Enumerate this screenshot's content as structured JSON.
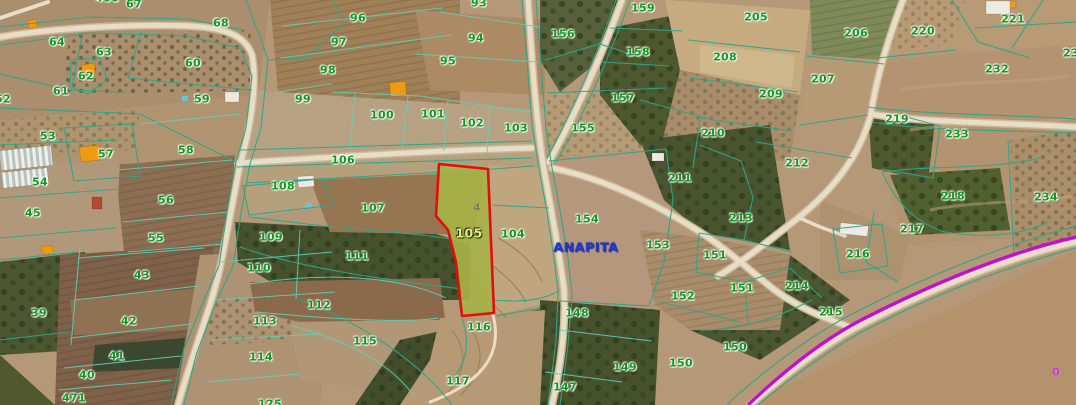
{
  "map": {
    "place_label": {
      "text": "ANAPITA",
      "x": 586,
      "y": 247
    },
    "road_marker": {
      "text": "0",
      "x": 1056,
      "y": 372
    },
    "highlighted_parcel": {
      "number": "105",
      "sub_label": "4",
      "label_x": 469,
      "label_y": 233,
      "sub_x": 477,
      "sub_y": 208,
      "polygon": "439,164 488,169 494,313 462,316 456,262 448,230 436,216"
    },
    "colors": {
      "boundary": "#2ca68b",
      "boundary-light": "#5fd0ba",
      "parcel-label": "#0c9b1c",
      "highlight-fill": "#a6b246",
      "highlight-outline": "#e30d0d",
      "highlight-label": "#dff07c",
      "place-label": "#1d39d4",
      "purple-road": "#bf10cf",
      "road-fill": "#e8ddc6",
      "road-casing": "#cbb999"
    },
    "parcel_labels": [
      {
        "t": "466",
        "x": 107,
        "y": -2
      },
      {
        "t": "67",
        "x": 134,
        "y": 4
      },
      {
        "t": "96",
        "x": 358,
        "y": 18
      },
      {
        "t": "93",
        "x": 479,
        "y": 3
      },
      {
        "t": "159",
        "x": 643,
        "y": 8
      },
      {
        "t": "205",
        "x": 756,
        "y": 17
      },
      {
        "t": "221",
        "x": 1013,
        "y": 19
      },
      {
        "t": "220",
        "x": 923,
        "y": 31
      },
      {
        "t": "68",
        "x": 221,
        "y": 23
      },
      {
        "t": "64",
        "x": 57,
        "y": 42
      },
      {
        "t": "97",
        "x": 339,
        "y": 42
      },
      {
        "t": "94",
        "x": 476,
        "y": 38
      },
      {
        "t": "156",
        "x": 563,
        "y": 34
      },
      {
        "t": "206",
        "x": 856,
        "y": 33
      },
      {
        "t": "63",
        "x": 104,
        "y": 52
      },
      {
        "t": "95",
        "x": 448,
        "y": 61
      },
      {
        "t": "158",
        "x": 638,
        "y": 52
      },
      {
        "t": "232",
        "x": 997,
        "y": 69
      },
      {
        "t": "23",
        "x": 1071,
        "y": 53
      },
      {
        "t": "62",
        "x": 86,
        "y": 76
      },
      {
        "t": "98",
        "x": 328,
        "y": 70
      },
      {
        "t": "60",
        "x": 193,
        "y": 63
      },
      {
        "t": "207",
        "x": 823,
        "y": 79
      },
      {
        "t": "208",
        "x": 725,
        "y": 57
      },
      {
        "t": "209",
        "x": 771,
        "y": 94
      },
      {
        "t": "61",
        "x": 61,
        "y": 91
      },
      {
        "t": "99",
        "x": 303,
        "y": 99
      },
      {
        "t": "59",
        "x": 202,
        "y": 99
      },
      {
        "t": "52",
        "x": 3,
        "y": 99
      },
      {
        "t": "100",
        "x": 382,
        "y": 115
      },
      {
        "t": "101",
        "x": 433,
        "y": 114
      },
      {
        "t": "102",
        "x": 472,
        "y": 123
      },
      {
        "t": "103",
        "x": 516,
        "y": 128
      },
      {
        "t": "157",
        "x": 623,
        "y": 98
      },
      {
        "t": "219",
        "x": 897,
        "y": 119
      },
      {
        "t": "210",
        "x": 713,
        "y": 133
      },
      {
        "t": "155",
        "x": 583,
        "y": 128
      },
      {
        "t": "233",
        "x": 957,
        "y": 134
      },
      {
        "t": "53",
        "x": 48,
        "y": 136
      },
      {
        "t": "58",
        "x": 186,
        "y": 150
      },
      {
        "t": "57",
        "x": 106,
        "y": 154
      },
      {
        "t": "106",
        "x": 343,
        "y": 160
      },
      {
        "t": "212",
        "x": 797,
        "y": 163
      },
      {
        "t": "211",
        "x": 680,
        "y": 178
      },
      {
        "t": "54",
        "x": 40,
        "y": 182
      },
      {
        "t": "108",
        "x": 283,
        "y": 186
      },
      {
        "t": "56",
        "x": 166,
        "y": 200
      },
      {
        "t": "218",
        "x": 953,
        "y": 196
      },
      {
        "t": "234",
        "x": 1046,
        "y": 197
      },
      {
        "t": "107",
        "x": 373,
        "y": 208
      },
      {
        "t": "45",
        "x": 33,
        "y": 213
      },
      {
        "t": "154",
        "x": 587,
        "y": 219
      },
      {
        "t": "213",
        "x": 741,
        "y": 218
      },
      {
        "t": "217",
        "x": 912,
        "y": 229
      },
      {
        "t": "104",
        "x": 513,
        "y": 234
      },
      {
        "t": "109",
        "x": 271,
        "y": 237
      },
      {
        "t": "55",
        "x": 156,
        "y": 238
      },
      {
        "t": "153",
        "x": 658,
        "y": 245
      },
      {
        "t": "151",
        "x": 715,
        "y": 255
      },
      {
        "t": "216",
        "x": 858,
        "y": 254
      },
      {
        "t": "111",
        "x": 357,
        "y": 256
      },
      {
        "t": "110",
        "x": 259,
        "y": 268
      },
      {
        "t": "43",
        "x": 142,
        "y": 275
      },
      {
        "t": "151",
        "x": 742,
        "y": 288
      },
      {
        "t": "214",
        "x": 797,
        "y": 286
      },
      {
        "t": "152",
        "x": 683,
        "y": 296
      },
      {
        "t": "112",
        "x": 319,
        "y": 305
      },
      {
        "t": "39",
        "x": 39,
        "y": 313
      },
      {
        "t": "215",
        "x": 831,
        "y": 312
      },
      {
        "t": "148",
        "x": 577,
        "y": 313
      },
      {
        "t": "42",
        "x": 129,
        "y": 321
      },
      {
        "t": "113",
        "x": 265,
        "y": 321
      },
      {
        "t": "116",
        "x": 479,
        "y": 327
      },
      {
        "t": "115",
        "x": 365,
        "y": 341
      },
      {
        "t": "150",
        "x": 735,
        "y": 347
      },
      {
        "t": "41",
        "x": 117,
        "y": 356
      },
      {
        "t": "114",
        "x": 261,
        "y": 357
      },
      {
        "t": "149",
        "x": 625,
        "y": 367
      },
      {
        "t": "150",
        "x": 681,
        "y": 363
      },
      {
        "t": "40",
        "x": 87,
        "y": 375
      },
      {
        "t": "117",
        "x": 458,
        "y": 381
      },
      {
        "t": "147",
        "x": 565,
        "y": 387
      },
      {
        "t": "471",
        "x": 74,
        "y": 398
      },
      {
        "t": "125",
        "x": 270,
        "y": 404
      }
    ],
    "buildings": [
      {
        "x": 28,
        "y": 20,
        "w": 9,
        "h": 8,
        "r": -15,
        "type": "orange"
      },
      {
        "x": 82,
        "y": 64,
        "w": 13,
        "h": 10,
        "r": -8,
        "type": "orange"
      },
      {
        "x": 80,
        "y": 146,
        "w": 20,
        "h": 15,
        "r": -6,
        "type": "orange"
      },
      {
        "x": 42,
        "y": 246,
        "w": 11,
        "h": 8,
        "r": 0,
        "type": "orange"
      },
      {
        "x": 390,
        "y": 82,
        "w": 16,
        "h": 14,
        "r": -4,
        "type": "orange"
      },
      {
        "x": 1007,
        "y": 1,
        "w": 9,
        "h": 7,
        "r": 0,
        "type": "orange"
      },
      {
        "x": 92,
        "y": 197,
        "w": 10,
        "h": 12,
        "r": 0,
        "type": "red-roof"
      },
      {
        "x": 840,
        "y": 224,
        "w": 28,
        "h": 11,
        "r": 6,
        "type": "white"
      },
      {
        "x": 986,
        "y": 1,
        "w": 24,
        "h": 13,
        "r": 0,
        "type": "white"
      },
      {
        "x": 652,
        "y": 153,
        "w": 12,
        "h": 8,
        "r": 0,
        "type": "white"
      },
      {
        "x": 298,
        "y": 176,
        "w": 16,
        "h": 11,
        "r": -4,
        "type": "white"
      },
      {
        "x": 225,
        "y": 92,
        "w": 14,
        "h": 10,
        "r": 0,
        "type": "white"
      },
      {
        "x": 0,
        "y": 148,
        "w": 52,
        "h": 20,
        "r": -6,
        "type": "greenhouse"
      },
      {
        "x": 2,
        "y": 170,
        "w": 46,
        "h": 16,
        "r": -6,
        "type": "greenhouse"
      },
      {
        "x": 182,
        "y": 96,
        "w": 6,
        "h": 5,
        "r": 0,
        "type": "pool"
      },
      {
        "x": 305,
        "y": 203,
        "w": 7,
        "h": 5,
        "r": 0,
        "type": "pool"
      }
    ]
  }
}
